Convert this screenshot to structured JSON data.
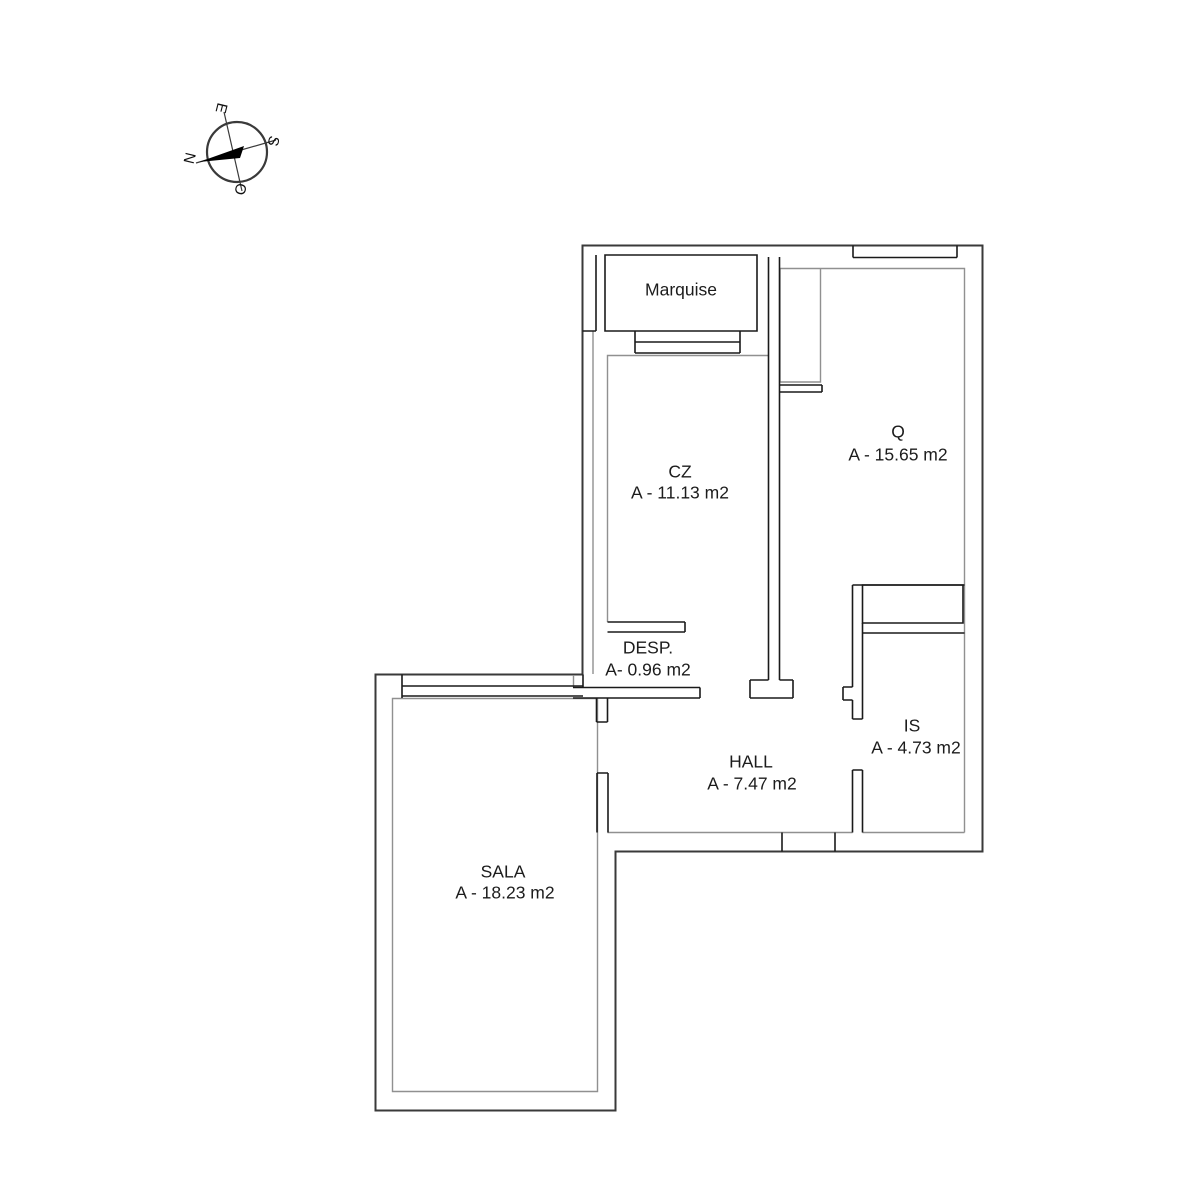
{
  "compass": {
    "north": "N",
    "east": "E",
    "south": "S",
    "west": "O"
  },
  "rooms": [
    {
      "id": "marquise",
      "name": "Marquise",
      "area": ""
    },
    {
      "id": "cz",
      "name": "CZ",
      "area": "A - 11.13 m2"
    },
    {
      "id": "q",
      "name": "Q",
      "area": "A - 15.65 m2"
    },
    {
      "id": "desp",
      "name": "DESP.",
      "area": "A- 0.96 m2"
    },
    {
      "id": "hall",
      "name": "HALL",
      "area": "A - 7.47 m2"
    },
    {
      "id": "is",
      "name": "IS",
      "area": "A - 4.73 m2"
    },
    {
      "id": "sala",
      "name": "SALA",
      "area": "A - 18.23 m2"
    }
  ],
  "colors": {
    "exterior_wall": "#3a3a3a",
    "partition_wall": "#1a1a1a",
    "finish_line": "#909090",
    "text": "#1c1c1c",
    "background": "#ffffff"
  }
}
